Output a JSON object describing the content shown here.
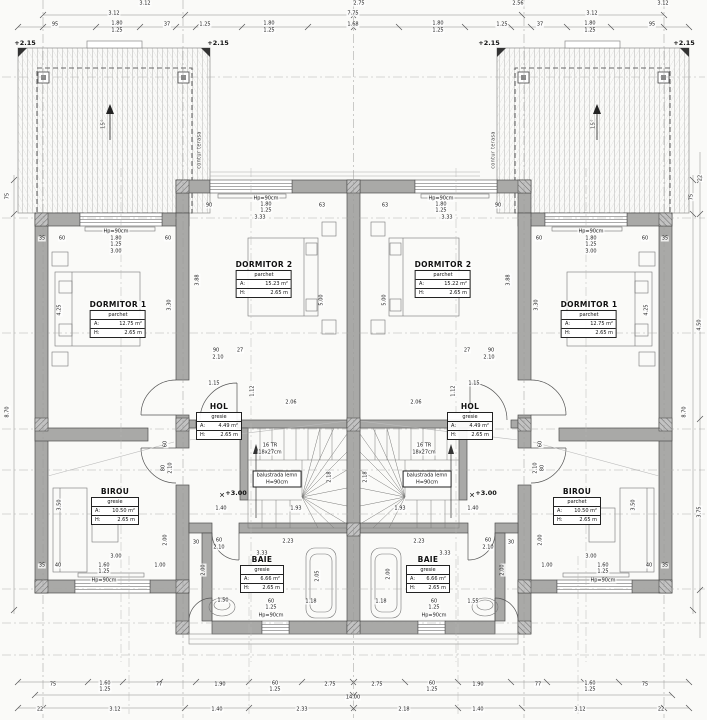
{
  "drawing": {
    "type": "floor-plan",
    "level_marks": [
      "+2.15",
      "+3.00"
    ],
    "stair_note": [
      "16 TR",
      "18x27cm"
    ],
    "balustrade_note": [
      "balustrada lemn",
      "H=90cm"
    ],
    "terrace_note": "contur terasa",
    "total_width_label": "14.00"
  },
  "rooms": [
    {
      "name": "DORMITOR 1",
      "material": "parchet",
      "a_label": "A:",
      "a_value": "12.75 m²",
      "h_label": "H:",
      "h_value": "2.65 m",
      "cx": 118,
      "ty": 301,
      "w": 54
    },
    {
      "name": "DORMITOR 2",
      "material": "parchet",
      "a_label": "A:",
      "a_value": "15.23 m²",
      "h_label": "H:",
      "h_value": "2.65 m",
      "cx": 264,
      "ty": 261,
      "w": 54
    },
    {
      "name": "HOL",
      "material": "gresie",
      "a_label": "A:",
      "a_value": "4.49 m²",
      "h_label": "H:",
      "h_value": "2.65 m",
      "cx": 219,
      "ty": 403,
      "w": 44
    },
    {
      "name": "BIROU",
      "material": "gresie",
      "a_label": "A:",
      "a_value": "10.50 m²",
      "h_label": "H:",
      "h_value": "2.65 m",
      "cx": 115,
      "ty": 488,
      "w": 46
    },
    {
      "name": "BAIE",
      "material": "gresie",
      "a_label": "A:",
      "a_value": "6.66 m²",
      "h_label": "H:",
      "h_value": "2.65 m",
      "cx": 262,
      "ty": 556,
      "w": 42
    },
    {
      "name": "DORMITOR 2",
      "material": "parchet",
      "a_label": "A:",
      "a_value": "15.22 m²",
      "h_label": "H:",
      "h_value": "2.65 m",
      "cx": 443,
      "ty": 261,
      "w": 54
    },
    {
      "name": "DORMITOR 1",
      "material": "parchet",
      "a_label": "A:",
      "a_value": "12.75 m²",
      "h_label": "H:",
      "h_value": "2.65 m",
      "cx": 589,
      "ty": 301,
      "w": 54
    },
    {
      "name": "HOL",
      "material": "gresie",
      "a_label": "A:",
      "a_value": "4.49 m²",
      "h_label": "H:",
      "h_value": "2.65 m",
      "cx": 470,
      "ty": 403,
      "w": 44
    },
    {
      "name": "BIROU",
      "material": "parchet",
      "a_label": "A:",
      "a_value": "10.50 m²",
      "h_label": "H:",
      "h_value": "2.65 m",
      "cx": 577,
      "ty": 488,
      "w": 46
    },
    {
      "name": "BAIE",
      "material": "gresie",
      "a_label": "A:",
      "a_value": "6.66 m²",
      "h_label": "H:",
      "h_value": "2.65 m",
      "cx": 428,
      "ty": 556,
      "w": 42
    }
  ],
  "stair_boxes": [
    {
      "l1": "balustrada lemn",
      "l2": "H=90cm",
      "cx": 277,
      "cy": 479
    },
    {
      "l1": "balustrada lemn",
      "l2": "H=90cm",
      "cx": 427,
      "cy": 479
    }
  ],
  "labels": [
    [
      "3.12",
      145,
      4
    ],
    [
      "2.75",
      359,
      4
    ],
    [
      "2.56",
      518,
      4
    ],
    [
      "3.12",
      663,
      4
    ],
    [
      "3.12",
      114,
      14
    ],
    [
      "7.75",
      353,
      14
    ],
    [
      "3.12",
      592,
      14
    ],
    [
      "95",
      55,
      25
    ],
    [
      "1.80",
      117,
      24
    ],
    [
      "1.25",
      117,
      31
    ],
    [
      "37",
      167,
      25
    ],
    [
      "1.25",
      205,
      25
    ],
    [
      "1.80",
      269,
      24
    ],
    [
      "1.25",
      269,
      31
    ],
    [
      "1.68",
      353,
      25
    ],
    [
      "1.80",
      438,
      24
    ],
    [
      "1.25",
      438,
      31
    ],
    [
      "1.25",
      502,
      25
    ],
    [
      "37",
      540,
      25
    ],
    [
      "1.80",
      590,
      24
    ],
    [
      "1.25",
      590,
      31
    ],
    [
      "95",
      652,
      25
    ],
    [
      "+2.15",
      25,
      43,
      0,
      "lv"
    ],
    [
      "+2.15",
      218,
      43,
      0,
      "lv"
    ],
    [
      "+2.15",
      489,
      43,
      0,
      "lv"
    ],
    [
      "+2.15",
      684,
      43,
      0,
      "lv"
    ],
    [
      "contur terasa",
      200,
      150,
      1,
      "nt"
    ],
    [
      "contur terasa",
      494,
      150,
      1,
      "nt"
    ],
    [
      "15°",
      104,
      124,
      1,
      "nt"
    ],
    [
      "15°",
      594,
      124,
      1,
      "nt"
    ],
    [
      "Hp=90cm",
      116,
      232
    ],
    [
      "1.80",
      116,
      239
    ],
    [
      "1.25",
      116,
      245
    ],
    [
      "3.00",
      116,
      252
    ],
    [
      "35",
      42,
      239
    ],
    [
      "60",
      62,
      239
    ],
    [
      "60",
      168,
      239
    ],
    [
      "Hp=90cm",
      591,
      232
    ],
    [
      "1.80",
      591,
      239
    ],
    [
      "1.25",
      591,
      245
    ],
    [
      "3.00",
      591,
      252
    ],
    [
      "35",
      665,
      239
    ],
    [
      "60",
      645,
      239
    ],
    [
      "60",
      539,
      239
    ],
    [
      "Hp=90cm",
      266,
      199
    ],
    [
      "90",
      209,
      206
    ],
    [
      "1.80",
      266,
      205
    ],
    [
      "1.25",
      266,
      211
    ],
    [
      "3.33",
      260,
      218
    ],
    [
      "63",
      322,
      206
    ],
    [
      "Hp=90cm",
      441,
      199
    ],
    [
      "63",
      385,
      206
    ],
    [
      "1.80",
      441,
      205
    ],
    [
      "1.25",
      441,
      211
    ],
    [
      "3.33",
      447,
      218
    ],
    [
      "90",
      498,
      206
    ],
    [
      "4.25",
      60,
      310,
      1
    ],
    [
      "3.30",
      170,
      305,
      1
    ],
    [
      "3.88",
      198,
      280,
      1
    ],
    [
      "5.00",
      322,
      300,
      1
    ],
    [
      "5.00",
      385,
      300,
      1
    ],
    [
      "3.88",
      509,
      280,
      1
    ],
    [
      "3.30",
      537,
      305,
      1
    ],
    [
      "4.25",
      647,
      310,
      1
    ],
    [
      "90",
      216,
      351
    ],
    [
      "27",
      240,
      351
    ],
    [
      "2.10",
      218,
      358
    ],
    [
      "90",
      491,
      351
    ],
    [
      "27",
      467,
      351
    ],
    [
      "2.10",
      489,
      358
    ],
    [
      "1.15",
      214,
      384
    ],
    [
      "2.06",
      291,
      403
    ],
    [
      "1.12",
      253,
      391,
      1
    ],
    [
      "1.15",
      474,
      384
    ],
    [
      "2.06",
      416,
      403
    ],
    [
      "1.12",
      454,
      391,
      1
    ],
    [
      "1.40",
      221,
      509
    ],
    [
      "1.40",
      473,
      509
    ],
    [
      "1.93",
      296,
      509
    ],
    [
      "1.93",
      400,
      509
    ],
    [
      "2.18",
      330,
      477,
      1
    ],
    [
      "2.18",
      366,
      477,
      1
    ],
    [
      "16 TR",
      270,
      446
    ],
    [
      "18x27cm",
      270,
      453
    ],
    [
      "16 TR",
      424,
      446
    ],
    [
      "18x27cm",
      424,
      453
    ],
    [
      "+3.00",
      236,
      493,
      0,
      "lv"
    ],
    [
      "+3.00",
      486,
      493,
      0,
      "lv"
    ],
    [
      "✕",
      222,
      496,
      0,
      "xm"
    ],
    [
      "✕",
      472,
      496,
      0,
      "xm"
    ],
    [
      "60",
      219,
      541
    ],
    [
      "2.10",
      219,
      548
    ],
    [
      "60",
      488,
      541
    ],
    [
      "2.10",
      488,
      548
    ],
    [
      "80",
      164,
      468,
      1
    ],
    [
      "2.10",
      171,
      468,
      1
    ],
    [
      "80",
      543,
      468,
      1
    ],
    [
      "2.10",
      536,
      468,
      1
    ],
    [
      "2.23",
      288,
      542
    ],
    [
      "2.23",
      419,
      542
    ],
    [
      "3.33",
      262,
      554
    ],
    [
      "3.33",
      445,
      554
    ],
    [
      "30",
      196,
      543
    ],
    [
      "30",
      511,
      543
    ],
    [
      "1.50",
      223,
      601
    ],
    [
      "60",
      271,
      602
    ],
    [
      "1.25",
      271,
      608
    ],
    [
      "Hp=90cm",
      271,
      616
    ],
    [
      "1.18",
      311,
      602
    ],
    [
      "2.05",
      318,
      576,
      1
    ],
    [
      "2.00",
      204,
      570,
      1
    ],
    [
      "1.18",
      381,
      602
    ],
    [
      "60",
      434,
      602
    ],
    [
      "1.25",
      434,
      608
    ],
    [
      "Hp=90cm",
      434,
      616
    ],
    [
      "1.55",
      473,
      602
    ],
    [
      "2.00",
      389,
      574,
      1
    ],
    [
      "2.00",
      503,
      570,
      1
    ],
    [
      "60",
      166,
      444,
      1
    ],
    [
      "2.00",
      166,
      540,
      1
    ],
    [
      "3.50",
      60,
      505,
      1
    ],
    [
      "3.00",
      116,
      557
    ],
    [
      "40",
      58,
      566
    ],
    [
      "1.60",
      104,
      566
    ],
    [
      "1.25",
      104,
      572
    ],
    [
      "1.00",
      160,
      566
    ],
    [
      "Hp=90cm",
      104,
      581
    ],
    [
      "35",
      42,
      566
    ],
    [
      "60",
      541,
      444,
      1
    ],
    [
      "2.00",
      541,
      540,
      1
    ],
    [
      "3.50",
      634,
      505,
      1
    ],
    [
      "3.00",
      591,
      557
    ],
    [
      "40",
      649,
      566
    ],
    [
      "1.60",
      603,
      566
    ],
    [
      "1.25",
      603,
      572
    ],
    [
      "1.00",
      547,
      566
    ],
    [
      "Hp=90cm",
      603,
      581
    ],
    [
      "35",
      665,
      566
    ],
    [
      "75",
      53,
      685
    ],
    [
      "1.60",
      105,
      684
    ],
    [
      "1.25",
      105,
      690
    ],
    [
      "77",
      159,
      685
    ],
    [
      "1.90",
      220,
      685
    ],
    [
      "60",
      275,
      684
    ],
    [
      "1.25",
      275,
      690
    ],
    [
      "2.75",
      330,
      685
    ],
    [
      "2.75",
      377,
      685
    ],
    [
      "60",
      432,
      684
    ],
    [
      "1.25",
      432,
      690
    ],
    [
      "1.90",
      478,
      685
    ],
    [
      "77",
      538,
      685
    ],
    [
      "1.60",
      590,
      684
    ],
    [
      "1.25",
      590,
      690
    ],
    [
      "75",
      645,
      685
    ],
    [
      "14.00",
      353,
      698
    ],
    [
      "22",
      40,
      710
    ],
    [
      "3.12",
      115,
      710
    ],
    [
      "1.40",
      217,
      710
    ],
    [
      "2.33",
      302,
      710
    ],
    [
      "2.18",
      404,
      710
    ],
    [
      "1.40",
      478,
      710
    ],
    [
      "3.12",
      580,
      710
    ],
    [
      "22",
      661,
      710
    ],
    [
      "75",
      8,
      196,
      1
    ],
    [
      "8.70",
      8,
      412,
      1
    ],
    [
      "22",
      701,
      178,
      1
    ],
    [
      "75",
      692,
      197,
      1
    ],
    [
      "4.50",
      700,
      325,
      1
    ],
    [
      "8.70",
      685,
      412,
      1
    ],
    [
      "3.75",
      700,
      512,
      1
    ]
  ]
}
